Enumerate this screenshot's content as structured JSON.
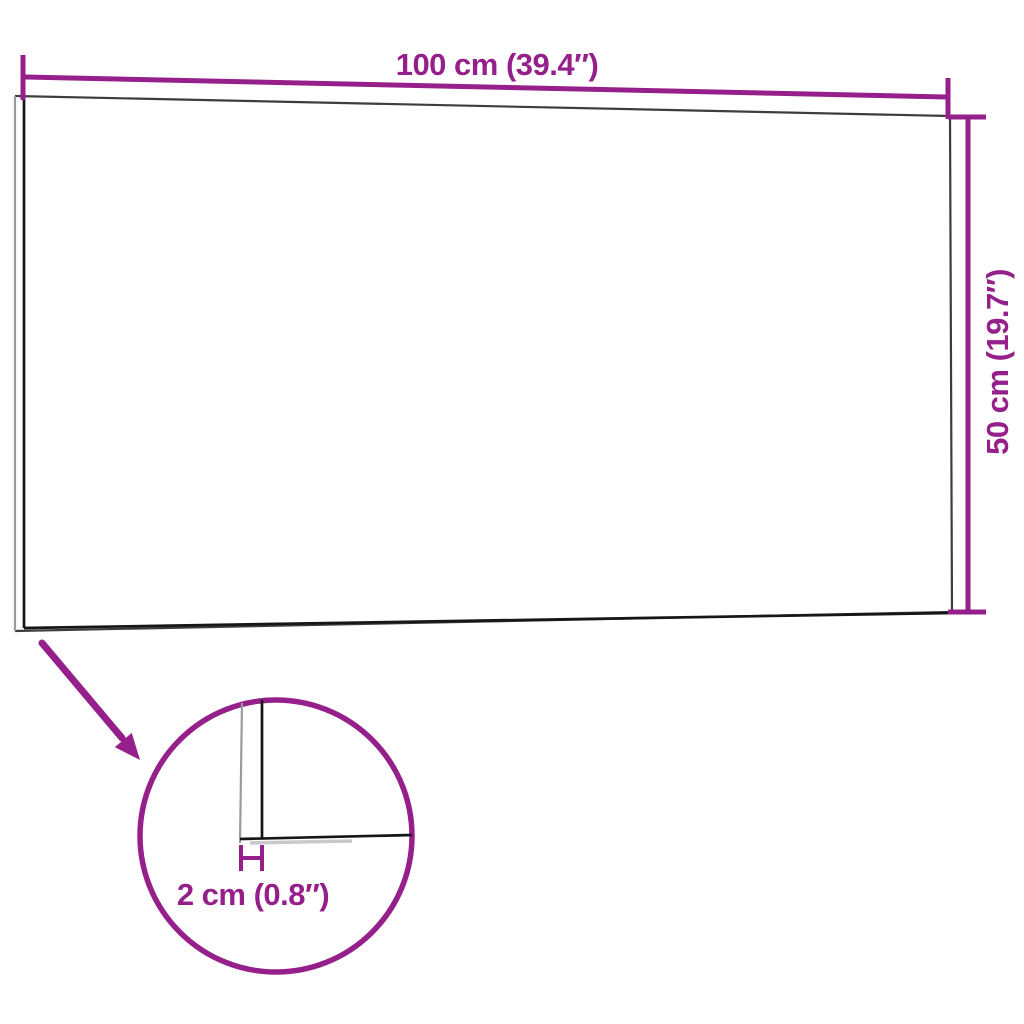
{
  "dimensions": {
    "width_label": "100 cm (39.4″)",
    "height_label": "50 cm (19.7″)",
    "thickness_label": "2 cm (0.8″)"
  },
  "colors": {
    "background": "#FFFFFF",
    "accent": "#96208B",
    "panel_edge": "#161616",
    "panel_outline": "#3D3D3D",
    "panel_side": "#9B9B9B",
    "detail_shadow": "#C9C9C9"
  }
}
